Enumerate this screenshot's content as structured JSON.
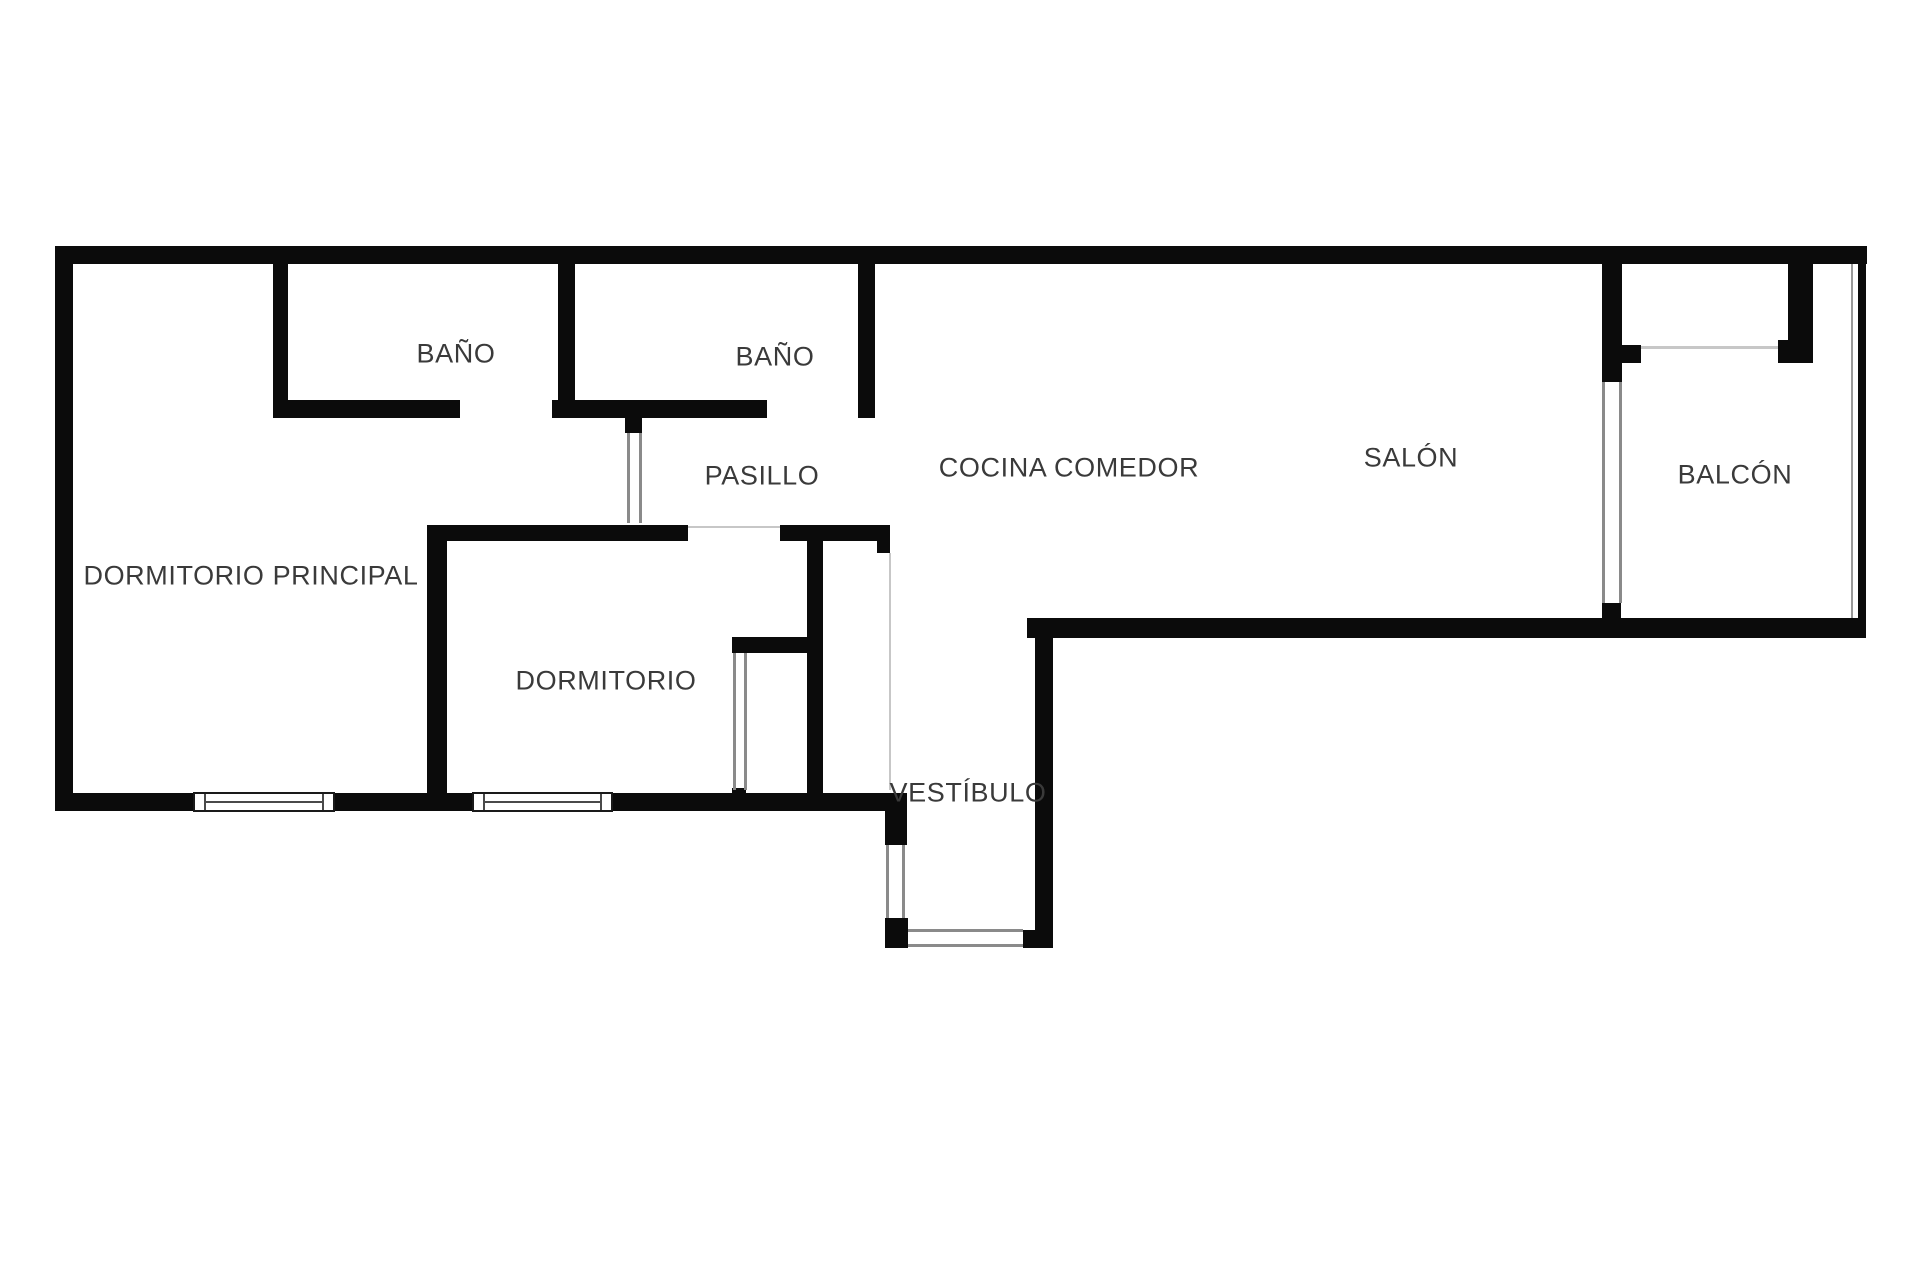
{
  "plan_title": "apartment-floor-plan",
  "colors": {
    "background": "#ffffff",
    "wall": "#0b0b0b",
    "label": "#3a3a3a",
    "door_frame": "#8a8a8a",
    "light_line": "#c7c7c7",
    "glazing": "#999999"
  },
  "rooms": [
    {
      "id": "bano-1",
      "label": "BAÑO",
      "cx": 456,
      "cy": 354
    },
    {
      "id": "bano-2",
      "label": "BAÑO",
      "cx": 775,
      "cy": 357
    },
    {
      "id": "pasillo",
      "label": "PASILLO",
      "cx": 762,
      "cy": 476
    },
    {
      "id": "cocina-comedor",
      "label": "COCINA COMEDOR",
      "cx": 1069,
      "cy": 468
    },
    {
      "id": "salon",
      "label": "SALÓN",
      "cx": 1411,
      "cy": 458
    },
    {
      "id": "balcon",
      "label": "BALCÓN",
      "cx": 1735,
      "cy": 475
    },
    {
      "id": "dormitorio-principal",
      "label": "DORMITORIO PRINCIPAL",
      "cx": 251,
      "cy": 576
    },
    {
      "id": "dormitorio",
      "label": "DORMITORIO",
      "cx": 606,
      "cy": 681
    },
    {
      "id": "vestibulo",
      "label": "VESTÍBULO",
      "cx": 968,
      "cy": 793
    }
  ],
  "walls": [
    {
      "id": "top-wall",
      "x": 55,
      "y": 246,
      "w": 1812,
      "h": 18
    },
    {
      "id": "left-wall",
      "x": 55,
      "y": 246,
      "w": 18,
      "h": 565
    },
    {
      "id": "bottom-wall-a",
      "x": 55,
      "y": 793,
      "w": 138,
      "h": 18
    },
    {
      "id": "bottom-wall-b",
      "x": 335,
      "y": 793,
      "w": 137,
      "h": 18
    },
    {
      "id": "bottom-wall-c",
      "x": 613,
      "y": 793,
      "w": 274,
      "h": 18
    },
    {
      "id": "vestibule-left-upper",
      "x": 885,
      "y": 793,
      "w": 22,
      "h": 52
    },
    {
      "id": "vestibule-left-block",
      "x": 885,
      "y": 918,
      "w": 23,
      "h": 30
    },
    {
      "id": "vestibule-right-wall",
      "x": 1035,
      "y": 618,
      "w": 18,
      "h": 330
    },
    {
      "id": "vestibule-right-block",
      "x": 1023,
      "y": 930,
      "w": 30,
      "h": 18
    },
    {
      "id": "kitchen-bottom-wall",
      "x": 1027,
      "y": 618,
      "w": 836,
      "h": 20
    },
    {
      "id": "right-glazing-wall",
      "x": 1858,
      "y": 246,
      "w": 8,
      "h": 392
    },
    {
      "id": "bath1-left-wall",
      "x": 273,
      "y": 264,
      "w": 15,
      "h": 154
    },
    {
      "id": "baths-bottom-a",
      "x": 273,
      "y": 400,
      "w": 187,
      "h": 18
    },
    {
      "id": "baths-bottom-b",
      "x": 552,
      "y": 400,
      "w": 215,
      "h": 18
    },
    {
      "id": "bath-divider-wall",
      "x": 558,
      "y": 264,
      "w": 17,
      "h": 154
    },
    {
      "id": "bath2-right-wall",
      "x": 858,
      "y": 264,
      "w": 17,
      "h": 154
    },
    {
      "id": "hall-door-stub",
      "x": 625,
      "y": 418,
      "w": 17,
      "h": 15
    },
    {
      "id": "bedroom-top-wall-a",
      "x": 427,
      "y": 525,
      "w": 261,
      "h": 16
    },
    {
      "id": "bedroom-top-wall-b",
      "x": 780,
      "y": 525,
      "w": 110,
      "h": 16
    },
    {
      "id": "bedroom-top-lip",
      "x": 877,
      "y": 525,
      "w": 13,
      "h": 28
    },
    {
      "id": "bedroom-left-wall",
      "x": 427,
      "y": 525,
      "w": 20,
      "h": 268
    },
    {
      "id": "bedroom-right-wall",
      "x": 807,
      "y": 541,
      "w": 16,
      "h": 252
    },
    {
      "id": "bedroom-closet-stub",
      "x": 732,
      "y": 637,
      "w": 75,
      "h": 16
    },
    {
      "id": "bedroom-closet-cap",
      "x": 732,
      "y": 788,
      "w": 14,
      "h": 9
    },
    {
      "id": "balcony-left-bar",
      "x": 1602,
      "y": 264,
      "w": 20,
      "h": 118
    },
    {
      "id": "balcony-left-foot",
      "x": 1602,
      "y": 345,
      "w": 39,
      "h": 18
    },
    {
      "id": "balcony-left-stub",
      "x": 1602,
      "y": 603,
      "w": 19,
      "h": 15
    },
    {
      "id": "balcony-right-bar",
      "x": 1788,
      "y": 264,
      "w": 25,
      "h": 76
    },
    {
      "id": "balcony-right-foot",
      "x": 1778,
      "y": 340,
      "w": 35,
      "h": 23
    }
  ],
  "thin_lines": [
    {
      "id": "hall-door-frame-l",
      "x": 627,
      "y": 433,
      "w": 3,
      "h": 90,
      "tone": "frame"
    },
    {
      "id": "hall-door-frame-r",
      "x": 639,
      "y": 433,
      "w": 3,
      "h": 90,
      "tone": "frame"
    },
    {
      "id": "closet-frame-l",
      "x": 733,
      "y": 653,
      "w": 3,
      "h": 137,
      "tone": "frame"
    },
    {
      "id": "closet-frame-r",
      "x": 744,
      "y": 653,
      "w": 3,
      "h": 137,
      "tone": "frame"
    },
    {
      "id": "vestibule-door-frame-l",
      "x": 886,
      "y": 845,
      "w": 3,
      "h": 73,
      "tone": "frame"
    },
    {
      "id": "vestibule-door-frame-r",
      "x": 902,
      "y": 845,
      "w": 3,
      "h": 73,
      "tone": "frame"
    },
    {
      "id": "entrance-threshold-top",
      "x": 908,
      "y": 929,
      "w": 115,
      "h": 3,
      "tone": "frame"
    },
    {
      "id": "entrance-threshold-bot",
      "x": 908,
      "y": 944,
      "w": 115,
      "h": 3,
      "tone": "frame"
    },
    {
      "id": "hall-kitchen-boundary",
      "x": 889,
      "y": 553,
      "w": 2,
      "h": 237,
      "tone": "light"
    },
    {
      "id": "bedroom-door-lintel",
      "x": 688,
      "y": 526,
      "w": 92,
      "h": 2,
      "tone": "light"
    },
    {
      "id": "balcony-threshold",
      "x": 1641,
      "y": 346,
      "w": 137,
      "h": 3,
      "tone": "light"
    },
    {
      "id": "balcony-door-frame-l",
      "x": 1602,
      "y": 382,
      "w": 3,
      "h": 221,
      "tone": "frame"
    },
    {
      "id": "balcony-door-frame-r",
      "x": 1619,
      "y": 382,
      "w": 3,
      "h": 221,
      "tone": "frame"
    },
    {
      "id": "glazing-inner-line",
      "x": 1851,
      "y": 264,
      "w": 2,
      "h": 354,
      "tone": "glazing"
    }
  ],
  "windows": [
    {
      "id": "window-principal",
      "x": 193,
      "y": 792,
      "w": 142,
      "h": 20
    },
    {
      "id": "window-dormitorio",
      "x": 472,
      "y": 792,
      "w": 141,
      "h": 20
    }
  ]
}
